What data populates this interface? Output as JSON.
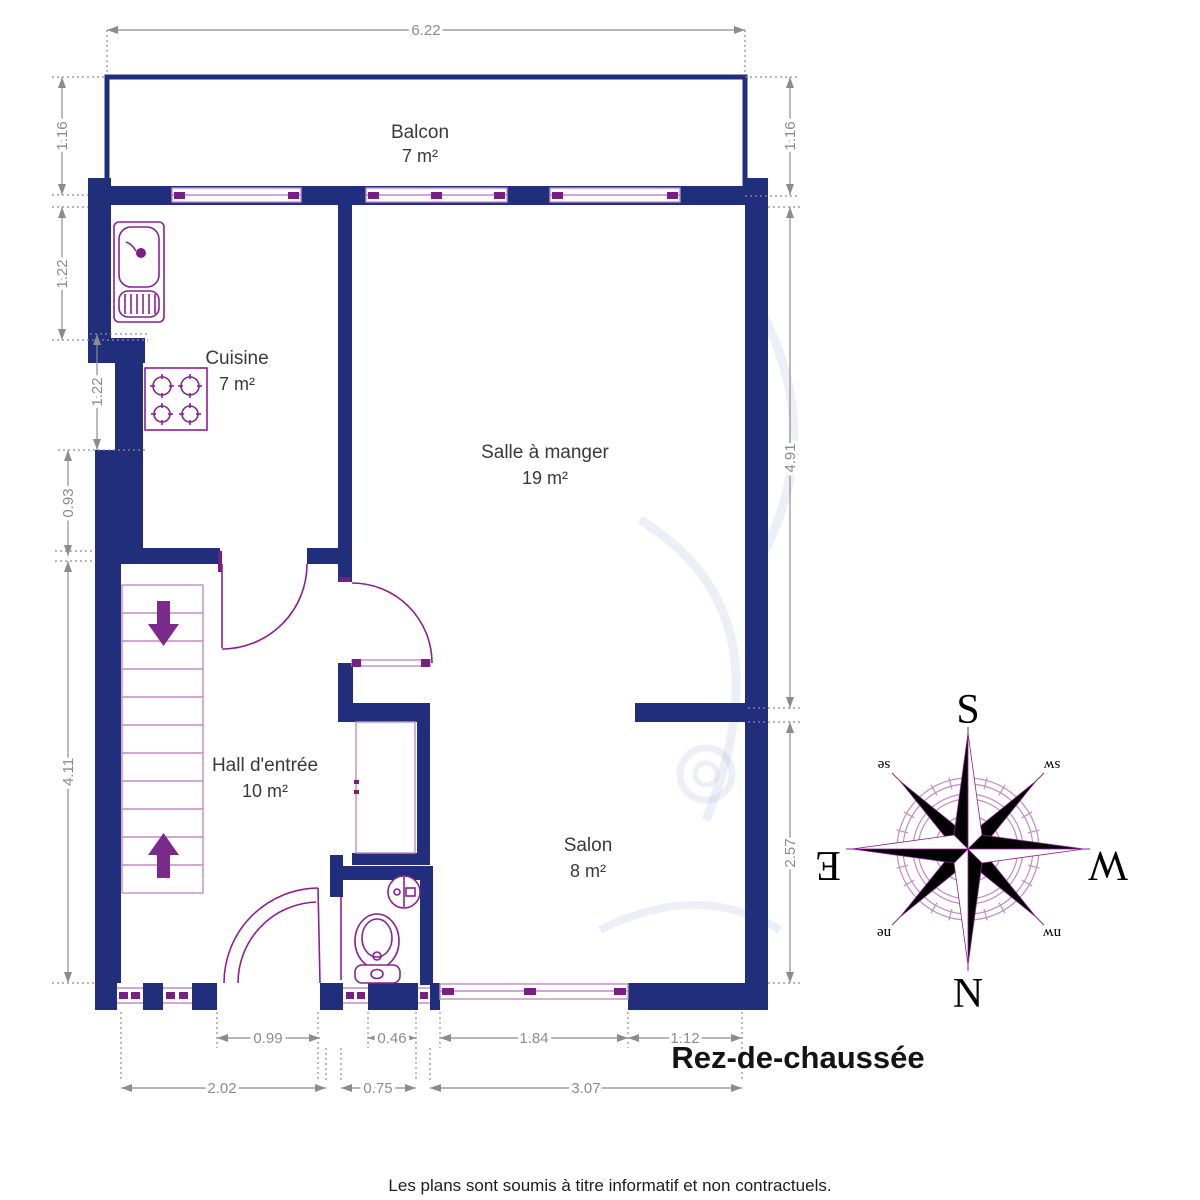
{
  "title": "Rez-de-chaussée",
  "footer": "Les plans sont soumis à titre informatif et non contractuels.",
  "rooms": [
    {
      "name": "Balcon",
      "area": "7 m²"
    },
    {
      "name": "Cuisine",
      "area": "7 m²"
    },
    {
      "name": "Salle à manger",
      "area": "19 m²"
    },
    {
      "name": "Hall d'entrée",
      "area": "10 m²"
    },
    {
      "name": "Salon",
      "area": "8 m²"
    }
  ],
  "dimensions": {
    "top": "6.22",
    "left": [
      "1.16",
      "1.22",
      "1.22",
      "0.93",
      "4.11"
    ],
    "right": [
      "1.16",
      "4.91",
      "2.57"
    ],
    "bottom_upper": [
      "0.99",
      "0.46",
      "1.84",
      "1.12"
    ],
    "bottom_lower": [
      "2.02",
      "0.75",
      "3.07"
    ]
  },
  "compass": {
    "cardinals": [
      "S",
      "N",
      "E",
      "W"
    ],
    "intercardinals": [
      "se",
      "sw",
      "ne",
      "nw"
    ]
  },
  "colors": {
    "wall": "#202e7c",
    "fixture": "#8a2190",
    "fixture_light": "#c08cc4",
    "fixture_dark": "#791e82",
    "arrow": "#7b2b8b",
    "dimension": "#8c8c8c",
    "label": "#3a3a3a"
  }
}
